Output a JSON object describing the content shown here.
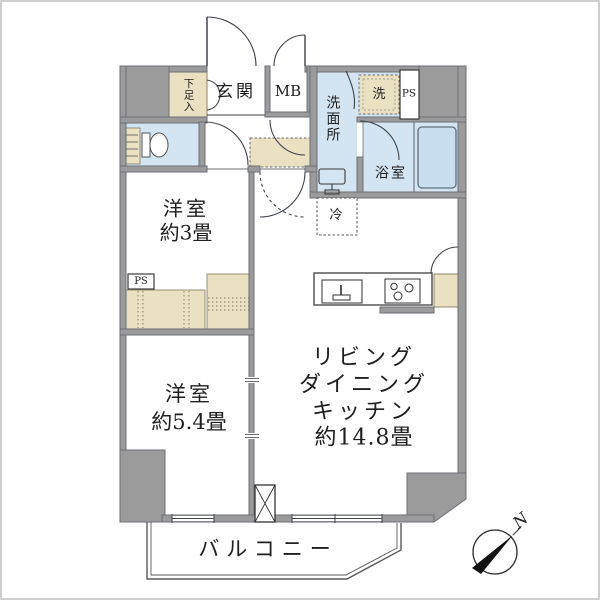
{
  "labels": {
    "genkan": "玄関",
    "shoebox": "下足入",
    "mb": "MB",
    "washroom": "洗面所",
    "washer": "洗",
    "ps_top": "PS",
    "ps_left": "PS",
    "bath": "浴室",
    "fridge": "冷",
    "room3": {
      "name": "洋室",
      "size": "約3畳"
    },
    "room54": {
      "name": "洋室",
      "size": "約5.4畳"
    },
    "ldk": {
      "l1": "リビング",
      "l2": "ダイニング",
      "l3": "キッチン",
      "l4": "約14.8畳"
    },
    "balcony": "バルコニー",
    "north": "N"
  },
  "colors": {
    "wall": "#9b9b9b",
    "wallEdge": "#6b6f76",
    "water": "#d3e4f2",
    "tub": "#c9def0",
    "storage": "#eae0c2",
    "line": "#3f434a",
    "frame": "#cfcfcf"
  }
}
